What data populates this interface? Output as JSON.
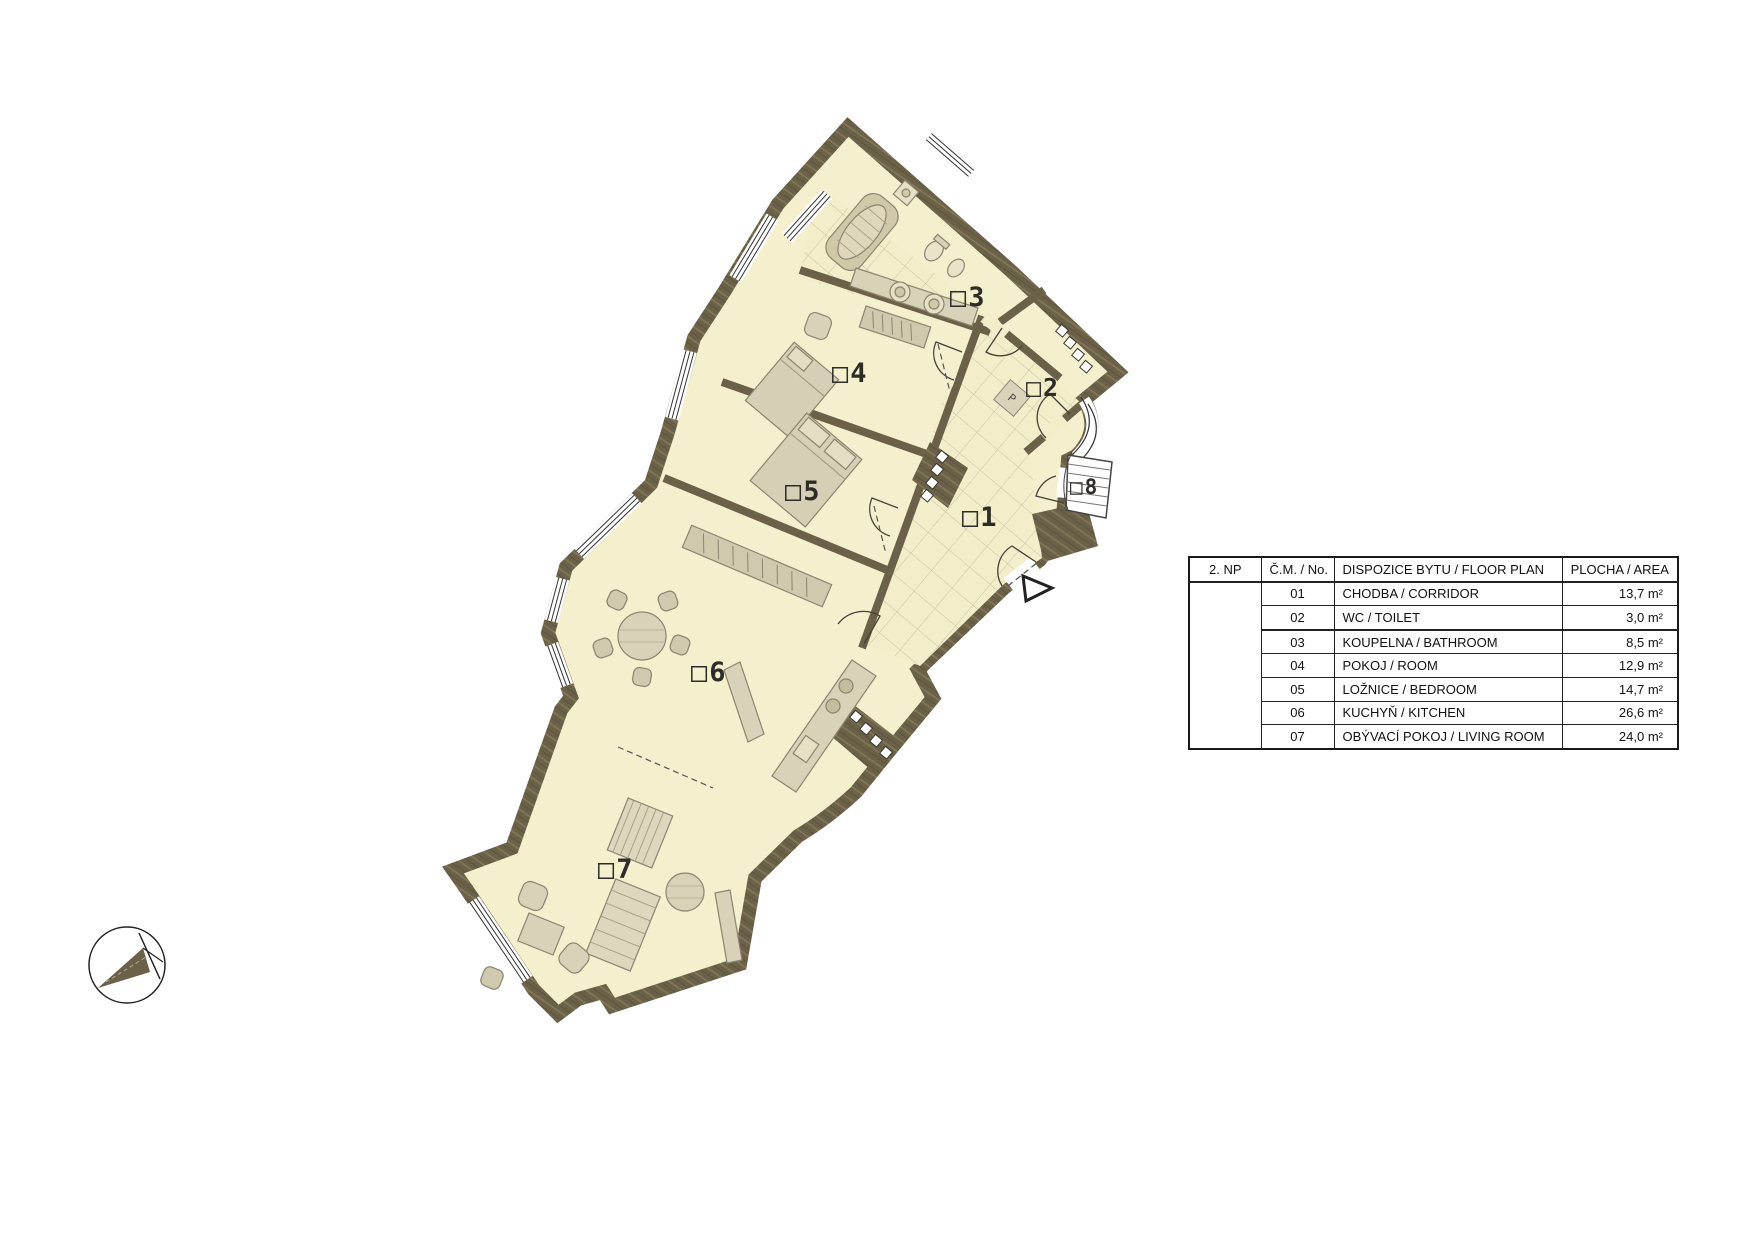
{
  "legend": {
    "floor": "2. NP",
    "col_no": "Č.M. / No.",
    "col_name": "DISPOZICE BYTU / FLOOR PLAN",
    "col_area": "PLOCHA / AREA",
    "rows": [
      {
        "no": "01",
        "name": "CHODBA / CORRIDOR",
        "area": "13,7 m²"
      },
      {
        "no": "02",
        "name": "WC / TOILET",
        "area": "3,0 m²"
      },
      {
        "no": "03",
        "name": "KOUPELNA / BATHROOM",
        "area": "8,5 m²"
      },
      {
        "no": "04",
        "name": "POKOJ / ROOM",
        "area": "12,9 m²"
      },
      {
        "no": "05",
        "name": "LOŽNICE / BEDROOM",
        "area": "14,7 m²"
      },
      {
        "no": "06",
        "name": "KUCHYŇ / KITCHEN",
        "area": "26,6 m²"
      },
      {
        "no": "07",
        "name": "OBÝVACÍ POKOJ / LIVING ROOM",
        "area": "24,0 m²"
      }
    ]
  },
  "plan": {
    "rooms": [
      {
        "label": "01"
      },
      {
        "label": "02"
      },
      {
        "label": "03"
      },
      {
        "label": "04"
      },
      {
        "label": "05"
      },
      {
        "label": "06"
      },
      {
        "label": "07"
      },
      {
        "label": "08"
      }
    ],
    "washer_mark": "P"
  },
  "colors": {
    "wall": "#6b6148",
    "wall_grain": "#8a7f5e",
    "floor": "#f4f0ce",
    "tile_line": "#c9c2a3",
    "furniture": "#d8d2b8",
    "label": "#2e2c28"
  }
}
